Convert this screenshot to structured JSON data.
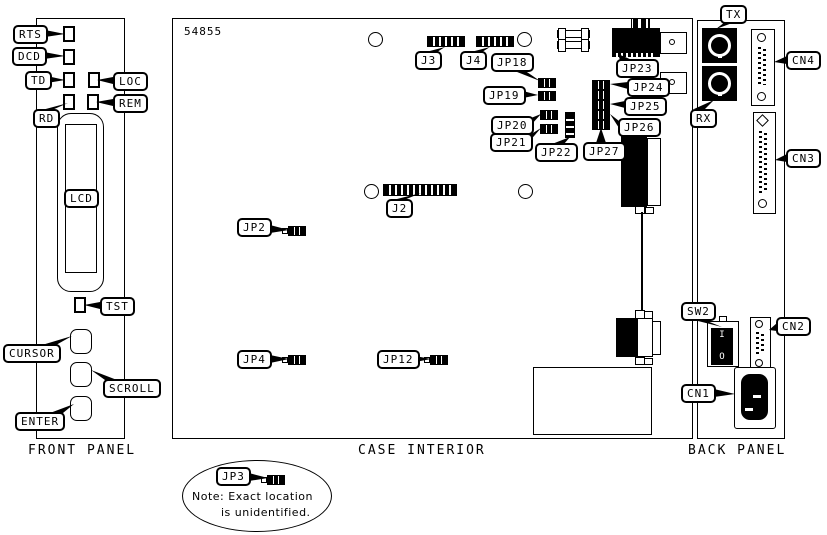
{
  "drawing_number": "54855",
  "captions": {
    "front": "FRONT PANEL",
    "case": "CASE INTERIOR",
    "back": "BACK PANEL"
  },
  "callouts": {
    "rts": "RTS",
    "dcd": "DCD",
    "td": "TD",
    "rd": "RD",
    "loc": "LOC",
    "rem": "REM",
    "lcd": "LCD",
    "tst": "TST",
    "cursor": "CURSOR",
    "scroll": "SCROLL",
    "enter": "ENTER",
    "j2": "J2",
    "j3": "J3",
    "j4": "J4",
    "jp2": "JP2",
    "jp3": "JP3",
    "jp4": "JP4",
    "jp12": "JP12",
    "jp18": "JP18",
    "jp19": "JP19",
    "jp20": "JP20",
    "jp21": "JP21",
    "jp22": "JP22",
    "jp23": "JP23",
    "jp24": "JP24",
    "jp25": "JP25",
    "jp26": "JP26",
    "jp27": "JP27",
    "tx": "TX",
    "rx": "RX",
    "cn1": "CN1",
    "cn2": "CN2",
    "cn3": "CN3",
    "cn4": "CN4",
    "sw2": "SW2"
  },
  "note": {
    "line1": "Note: Exact location",
    "line2": "is unidentified."
  },
  "power_switch": {
    "on": "I",
    "off": "O"
  }
}
